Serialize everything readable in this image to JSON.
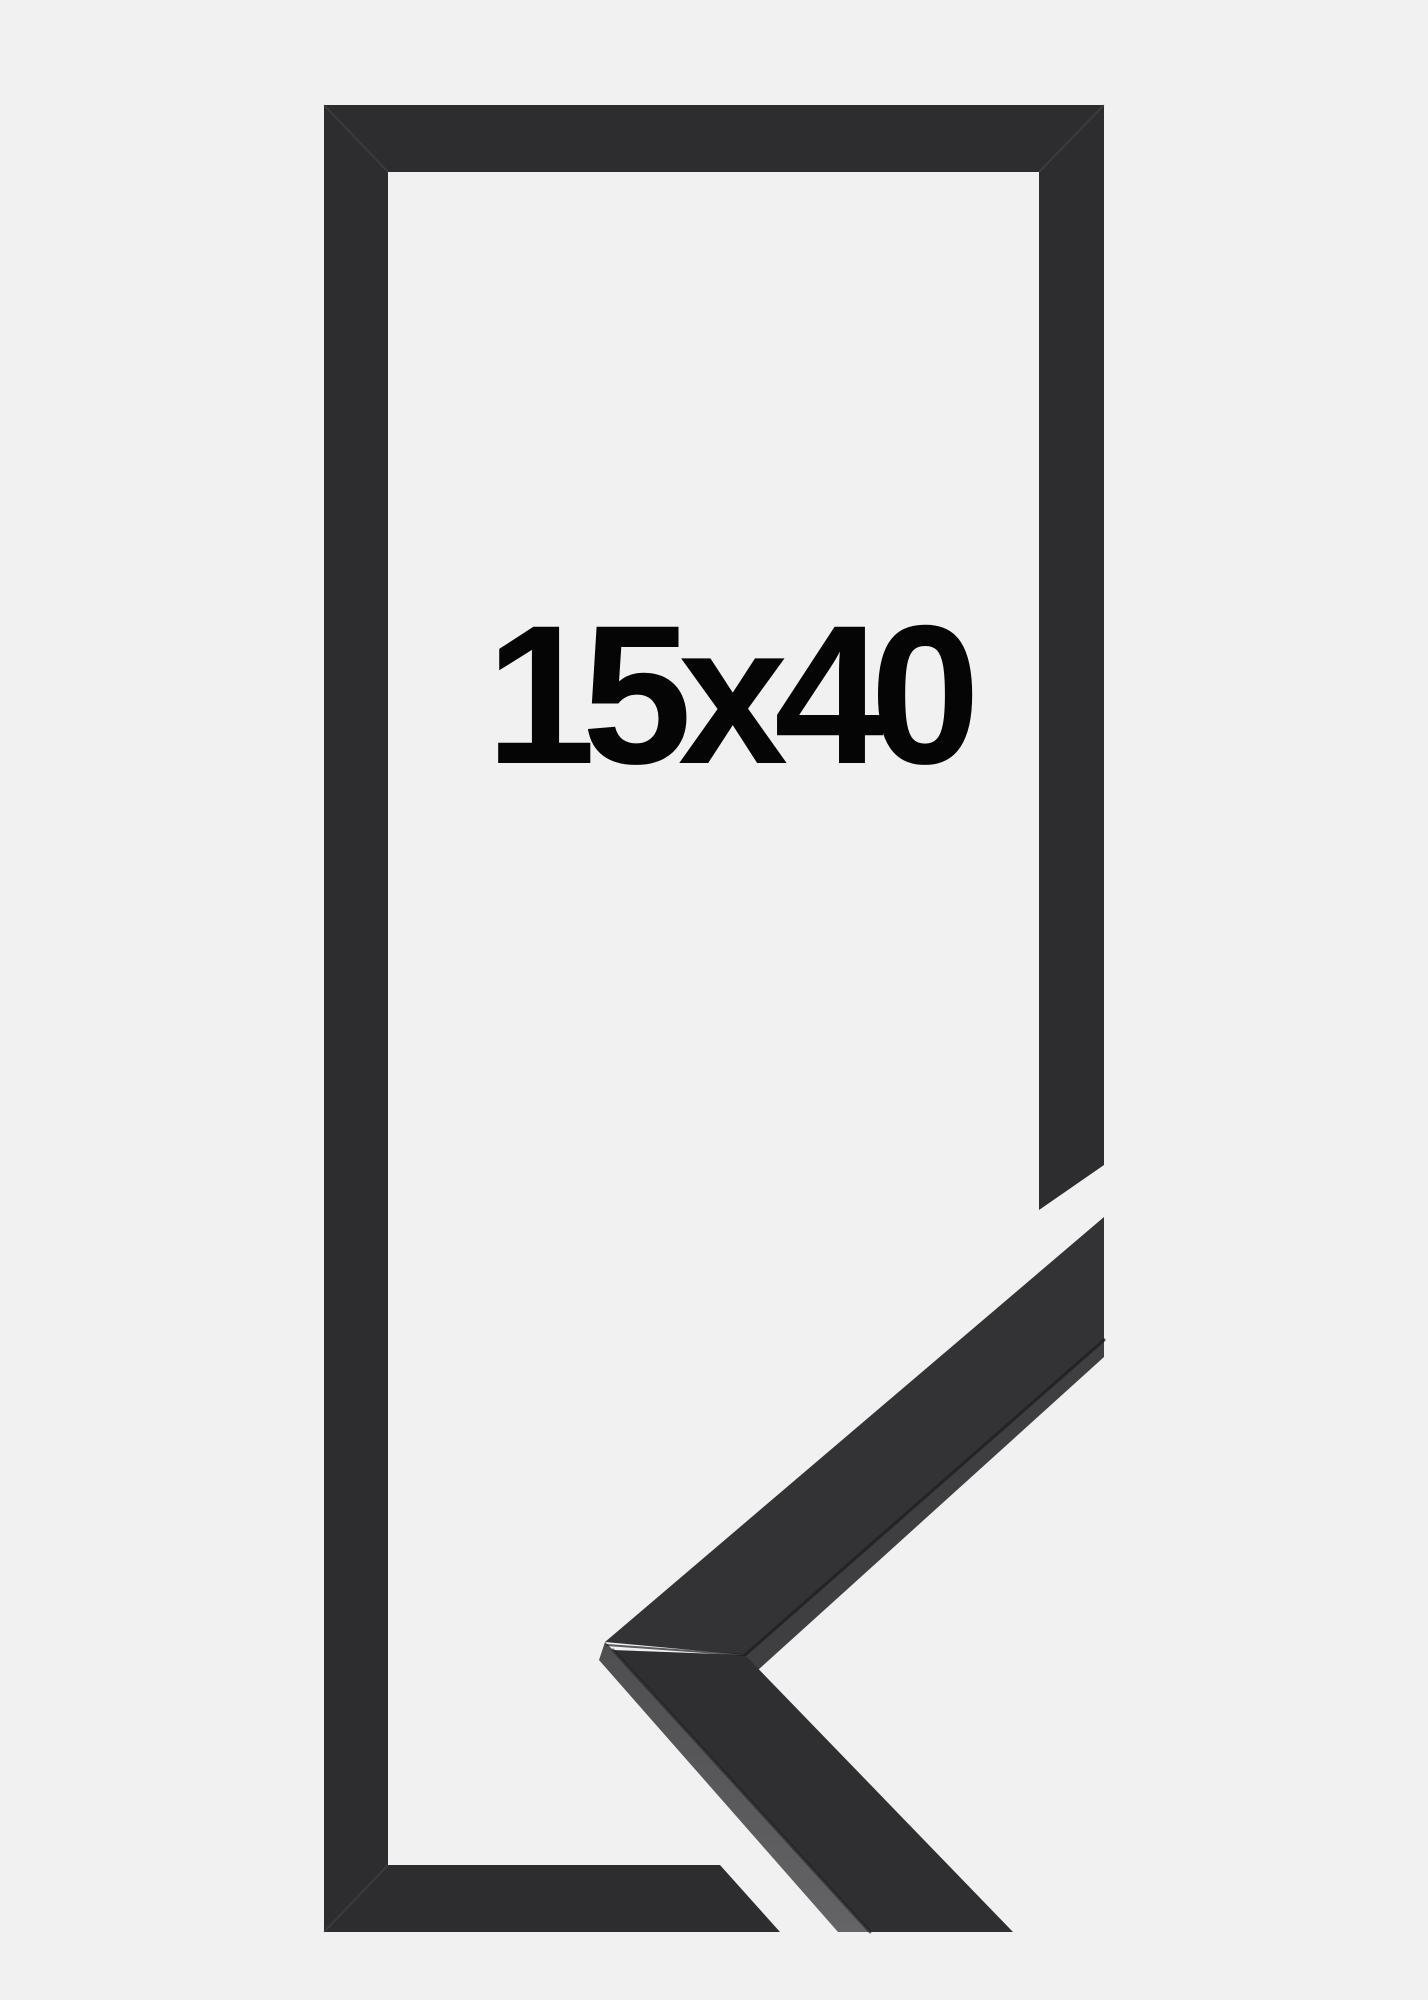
{
  "product_image": {
    "size_label": "15x40"
  },
  "colors": {
    "background": "#f1f1f2",
    "frame": "#2d2d2f",
    "sample_face_upper": "#333335",
    "sample_face_lower": "#2f2f31",
    "rabbet_strip": "#3f3f41",
    "side_face_dark": "#4e4e50",
    "side_face_light": "#646466",
    "seam": "#1d1d1f",
    "miter_seam": "#565658",
    "label_text": "#050505"
  }
}
